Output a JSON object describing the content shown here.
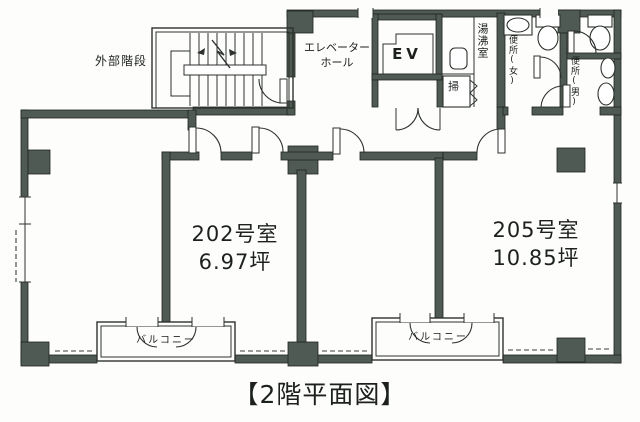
{
  "title": "【2階平面図】",
  "colors": {
    "wall": "#4e5a53",
    "ink": "#1d211e",
    "paper": "#fdfdfb"
  },
  "labels": {
    "external_stairs": "外部階段",
    "elevator_hall_1": "エレベーター",
    "elevator_hall_2": "ホール",
    "elevator": "EV",
    "hot_water_room": "湯沸室",
    "toilet_women": "便所(女)",
    "toilet_men": "便所(男)",
    "cleaning_closet": "掃",
    "balcony": "バルコニー"
  },
  "rooms": [
    {
      "name": "202号室",
      "area": "6.97坪"
    },
    {
      "name": "205号室",
      "area": "10.85坪"
    }
  ]
}
